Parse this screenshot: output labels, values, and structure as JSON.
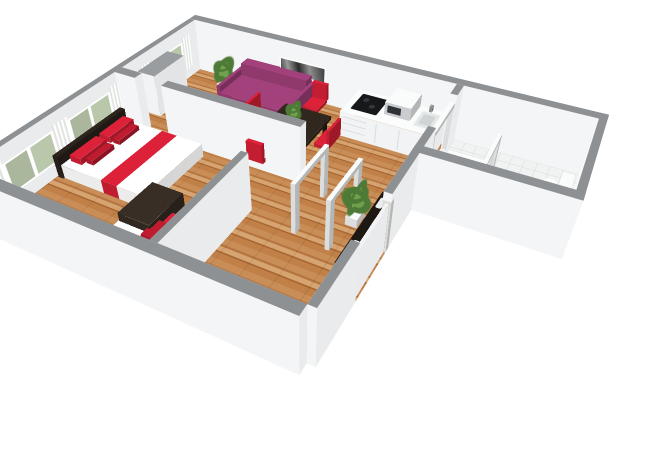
{
  "scene": {
    "description": "3D cutaway floor plan render of a one-bedroom apartment seen from above",
    "background": "#ffffff"
  },
  "palette": {
    "wall_cap": "#8e9194",
    "wall_outer": "#f4f5f6",
    "wall_inner": "#f8f9f9",
    "wall_side": "#e9ebec",
    "white_furniture": "#fafbfb",
    "floor_plank_a": "#c98e58",
    "floor_plank_b": "#b4743f",
    "floor_plank_c": "#d6a470",
    "floor_plank_d": "#a4632f",
    "tile": "#f1f2f2",
    "tile_line": "#d9dcdc",
    "accent_red": "#dd2138",
    "accent_red_dark": "#bf1c30",
    "sofa_purple": "#a2417c",
    "dark_wood": "#2c241d",
    "darker_wood": "#1e1813",
    "shelf_black": "#17120e",
    "plant_green_dark": "#4d7a36",
    "plant_green_light": "#6fa14e",
    "window_glass": "#b9c7ab",
    "curtain": "#f2f3f0",
    "metal": "#9ba0a4",
    "door_wood": "#c0763d",
    "shower_tray": "#ddd3ba",
    "glass": "rgba(195,205,210,0.45)",
    "cooktop_black": "#16181a",
    "tv_gray": "#6a6f73",
    "art_frame": "#ffffff"
  },
  "rooms": [
    {
      "name": "living-room",
      "furniture": [
        "sofa",
        "coffee-table",
        "wall-art",
        "tv-stand",
        "tv",
        "tall-cabinet",
        "potted-plant"
      ]
    },
    {
      "name": "dining-area",
      "furniture": [
        "dining-table",
        "table-plant",
        "dining-chair-north",
        "dining-chair-west",
        "dining-chair-south",
        "dining-chair-east"
      ]
    },
    {
      "name": "kitchen",
      "furniture": [
        "kitchen-counter",
        "cooktop",
        "microwave",
        "kitchen-sink"
      ]
    },
    {
      "name": "hallway",
      "furniture": [
        "doorway-frame-1",
        "doorway-frame-2",
        "potted-plant",
        "shoe-rack",
        "entry-door"
      ]
    },
    {
      "name": "bedroom",
      "furniture": [
        "double-bed",
        "single-bed",
        "dresser",
        "potted-plant",
        "windows"
      ]
    },
    {
      "name": "bathroom",
      "furniture": [
        "shower",
        "toilet",
        "wash-basin",
        "doorway-frame"
      ]
    }
  ]
}
